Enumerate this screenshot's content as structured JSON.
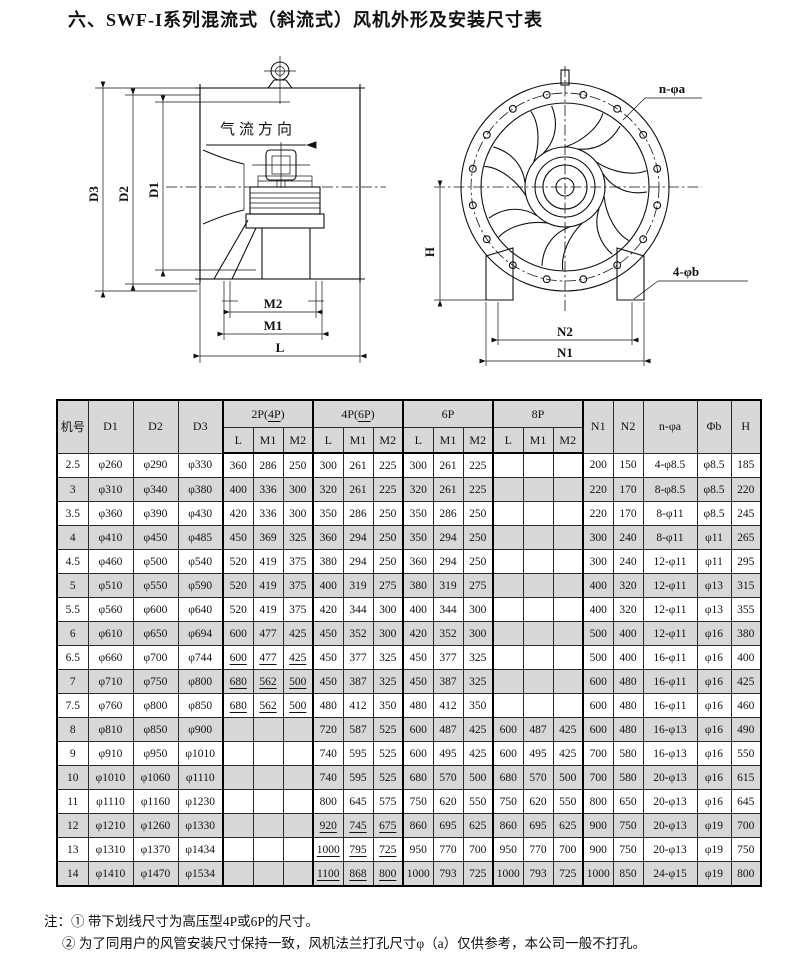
{
  "title": "六、SWF-I系列混流式（斜流式）风机外形及安装尺寸表",
  "drawings": {
    "left": {
      "airflow_label": "气流方向",
      "dim_d3": "D3",
      "dim_d2": "D2",
      "dim_d1": "D1",
      "dim_m2": "M2",
      "dim_m1": "M1",
      "dim_l": "L"
    },
    "right": {
      "bolt_circle_label": "n-φa",
      "foot_hole_label": "4-φb",
      "dim_h": "H",
      "dim_n2": "N2",
      "dim_n1": "N1"
    }
  },
  "table": {
    "header": {
      "col_machine": "机号",
      "col_d1": "D1",
      "col_d2": "D2",
      "col_d3": "D3",
      "groups": [
        {
          "label_pre": "2P(",
          "label_u": "4P",
          "label_post": ")"
        },
        {
          "label_pre": "4P(",
          "label_u": "6P",
          "label_post": ")"
        },
        {
          "label_pre": "6P",
          "label_u": "",
          "label_post": ""
        },
        {
          "label_pre": "8P",
          "label_u": "",
          "label_post": ""
        }
      ],
      "sub": [
        "L",
        "M1",
        "M2"
      ],
      "col_n1": "N1",
      "col_n2": "N2",
      "col_na": "n-φa",
      "col_b": "Φb",
      "col_h": "H"
    },
    "rows": [
      {
        "cells": [
          "2.5",
          "φ260",
          "φ290",
          "φ330",
          "360",
          "286",
          "250",
          "300",
          "261",
          "225",
          "300",
          "261",
          "225",
          "",
          "",
          "",
          "200",
          "150",
          "4-φ8.5",
          "φ8.5",
          "185"
        ],
        "underline": []
      },
      {
        "cells": [
          "3",
          "φ310",
          "φ340",
          "φ380",
          "400",
          "336",
          "300",
          "320",
          "261",
          "225",
          "320",
          "261",
          "225",
          "",
          "",
          "",
          "220",
          "170",
          "8-φ8.5",
          "φ8.5",
          "220"
        ],
        "underline": []
      },
      {
        "cells": [
          "3.5",
          "φ360",
          "φ390",
          "φ430",
          "420",
          "336",
          "300",
          "350",
          "286",
          "250",
          "350",
          "286",
          "250",
          "",
          "",
          "",
          "220",
          "170",
          "8-φ11",
          "φ8.5",
          "245"
        ],
        "underline": []
      },
      {
        "cells": [
          "4",
          "φ410",
          "φ450",
          "φ485",
          "450",
          "369",
          "325",
          "360",
          "294",
          "250",
          "350",
          "294",
          "250",
          "",
          "",
          "",
          "300",
          "240",
          "8-φ11",
          "φ11",
          "265"
        ],
        "underline": []
      },
      {
        "cells": [
          "4.5",
          "φ460",
          "φ500",
          "φ540",
          "520",
          "419",
          "375",
          "380",
          "294",
          "250",
          "360",
          "294",
          "250",
          "",
          "",
          "",
          "300",
          "240",
          "12-φ11",
          "φ11",
          "295"
        ],
        "underline": []
      },
      {
        "cells": [
          "5",
          "φ510",
          "φ550",
          "φ590",
          "520",
          "419",
          "375",
          "400",
          "319",
          "275",
          "380",
          "319",
          "275",
          "",
          "",
          "",
          "400",
          "320",
          "12-φ11",
          "φ13",
          "315"
        ],
        "underline": []
      },
      {
        "cells": [
          "5.5",
          "φ560",
          "φ600",
          "φ640",
          "520",
          "419",
          "375",
          "420",
          "344",
          "300",
          "400",
          "344",
          "300",
          "",
          "",
          "",
          "400",
          "320",
          "12-φ11",
          "φ13",
          "355"
        ],
        "underline": []
      },
      {
        "cells": [
          "6",
          "φ610",
          "φ650",
          "φ694",
          "600",
          "477",
          "425",
          "450",
          "352",
          "300",
          "420",
          "352",
          "300",
          "",
          "",
          "",
          "500",
          "400",
          "12-φ11",
          "φ16",
          "380"
        ],
        "underline": []
      },
      {
        "cells": [
          "6.5",
          "φ660",
          "φ700",
          "φ744",
          "600",
          "477",
          "425",
          "450",
          "377",
          "325",
          "450",
          "377",
          "325",
          "",
          "",
          "",
          "500",
          "400",
          "16-φ11",
          "φ16",
          "400"
        ],
        "underline": [
          4,
          5,
          6
        ]
      },
      {
        "cells": [
          "7",
          "φ710",
          "φ750",
          "φ800",
          "680",
          "562",
          "500",
          "450",
          "387",
          "325",
          "450",
          "387",
          "325",
          "",
          "",
          "",
          "600",
          "480",
          "16-φ11",
          "φ16",
          "425"
        ],
        "underline": [
          4,
          5,
          6
        ]
      },
      {
        "cells": [
          "7.5",
          "φ760",
          "φ800",
          "φ850",
          "680",
          "562",
          "500",
          "480",
          "412",
          "350",
          "480",
          "412",
          "350",
          "",
          "",
          "",
          "600",
          "480",
          "16-φ11",
          "φ16",
          "460"
        ],
        "underline": [
          4,
          5,
          6
        ]
      },
      {
        "cells": [
          "8",
          "φ810",
          "φ850",
          "φ900",
          "",
          "",
          "",
          "720",
          "587",
          "525",
          "600",
          "487",
          "425",
          "600",
          "487",
          "425",
          "600",
          "480",
          "16-φ13",
          "φ16",
          "490"
        ],
        "underline": []
      },
      {
        "cells": [
          "9",
          "φ910",
          "φ950",
          "φ1010",
          "",
          "",
          "",
          "740",
          "595",
          "525",
          "600",
          "495",
          "425",
          "600",
          "495",
          "425",
          "700",
          "580",
          "16-φ13",
          "φ16",
          "550"
        ],
        "underline": []
      },
      {
        "cells": [
          "10",
          "φ1010",
          "φ1060",
          "φ1110",
          "",
          "",
          "",
          "740",
          "595",
          "525",
          "680",
          "570",
          "500",
          "680",
          "570",
          "500",
          "700",
          "580",
          "20-φ13",
          "φ16",
          "615"
        ],
        "underline": []
      },
      {
        "cells": [
          "11",
          "φ1110",
          "φ1160",
          "φ1230",
          "",
          "",
          "",
          "800",
          "645",
          "575",
          "750",
          "620",
          "550",
          "750",
          "620",
          "550",
          "800",
          "650",
          "20-φ13",
          "φ16",
          "645"
        ],
        "underline": []
      },
      {
        "cells": [
          "12",
          "φ1210",
          "φ1260",
          "φ1330",
          "",
          "",
          "",
          "920",
          "745",
          "675",
          "860",
          "695",
          "625",
          "860",
          "695",
          "625",
          "900",
          "750",
          "20-φ13",
          "φ19",
          "700"
        ],
        "underline": [
          7,
          8,
          9
        ]
      },
      {
        "cells": [
          "13",
          "φ1310",
          "φ1370",
          "φ1434",
          "",
          "",
          "",
          "1000",
          "795",
          "725",
          "950",
          "770",
          "700",
          "950",
          "770",
          "700",
          "900",
          "750",
          "20-φ13",
          "φ19",
          "750"
        ],
        "underline": [
          7,
          8,
          9
        ]
      },
      {
        "cells": [
          "14",
          "φ1410",
          "φ1470",
          "φ1534",
          "",
          "",
          "",
          "1100",
          "868",
          "800",
          "1000",
          "793",
          "725",
          "1000",
          "793",
          "725",
          "1000",
          "850",
          "24-φ15",
          "φ19",
          "800"
        ],
        "underline": [
          7,
          8,
          9
        ]
      }
    ]
  },
  "notes": {
    "prefix": "注：",
    "line1": "① 带下划线尺寸为高压型4P或6P的尺寸。",
    "line2": "② 为了同用户的风管安装尺寸保持一致，风机法兰打孔尺寸φ（a）仅供参考，本公司一般不打孔。"
  },
  "colors": {
    "row_shade": "#d8d8d8",
    "ink": "#111111"
  }
}
